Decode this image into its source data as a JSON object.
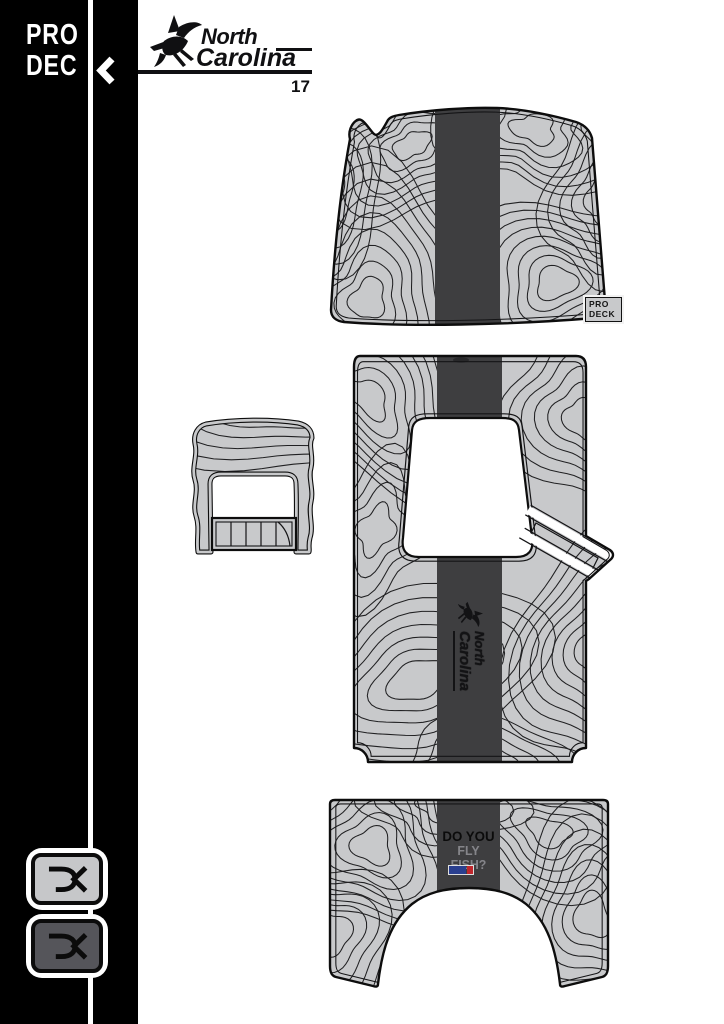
{
  "sidebar": {
    "logo": {
      "line1": "PRO",
      "line2": "DEC",
      "chevron": "left-chevron"
    },
    "monograms": [
      {
        "variant": "light"
      },
      {
        "variant": "dark"
      }
    ]
  },
  "header": {
    "brand_top": "North",
    "brand_bottom": "Carolina",
    "model": "17"
  },
  "pads": {
    "bow": {
      "badge_line1": "PRO",
      "badge_line2": "DECK"
    },
    "cockpit": {
      "watermark_top": "North",
      "watermark_bottom": "Carolina"
    },
    "stern": {
      "question_line1": "DO YOU",
      "question_line2": "FLY FISH?"
    }
  },
  "colors": {
    "sidebar": "#000000",
    "pad_fill": "#c8c9cb",
    "stripe": "#3e3e40",
    "contour": "#202022",
    "monogram_light_fill": "#c6c7c9",
    "monogram_dark_fill": "#55555a",
    "flag_blue": "#2a3f8f",
    "flag_red": "#c0272d"
  }
}
